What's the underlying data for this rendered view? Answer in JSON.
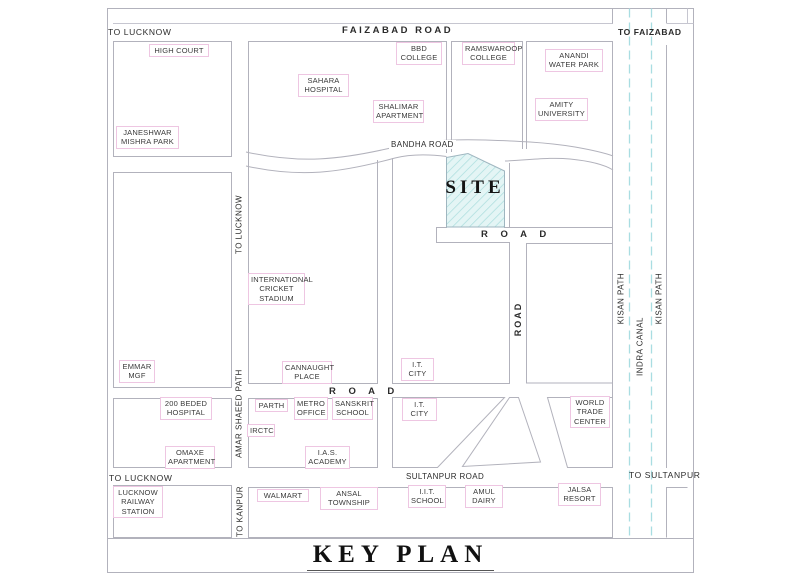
{
  "title": {
    "text": "KEY PLAN"
  },
  "site": {
    "label": "SITE"
  },
  "roads": {
    "to_lucknow_top": "TO LUCKNOW",
    "faizabad_road": "FAIZABAD ROAD",
    "to_faizabad": "TO FAIZABAD",
    "bandha_road": "BANDHA ROAD",
    "road_site": "R O A D",
    "road_mid": "R O A D",
    "road_vertical": "ROAD",
    "sultanpur_road": "SULTANPUR ROAD",
    "to_sultanpur": "TO SULTANPUR",
    "to_lucknow_bottom": "TO LUCKNOW",
    "to_lucknow_left": "TO LUCKNOW",
    "amar_shaeed_path": "AMAR SHAEED PATH",
    "to_kanpur": "TO KANPUR",
    "kisan_path_west": "KISAN PATH",
    "kisan_path_east": "KISAN PATH",
    "indra_canal": "INDRA CANAL"
  },
  "places": {
    "high_court": "HIGH COURT",
    "janeshwar_mishra_park": "JANESHWAR\nMISHRA PARK",
    "sahara_hospital": "SAHARA\nHOSPITAL",
    "bbd_college": "BBD\nCOLLEGE",
    "ramswaroop_college": "RAMSWAROOP\nCOLLEGE",
    "anandi_water_park": "ANANDI\nWATER PARK",
    "shalimar_apartment": "SHALIMAR\nAPARTMENT",
    "amity_university": "AMITY\nUNIVERSITY",
    "international_cricket_stadium": "INTERNATIONAL\nCRICKET\nSTADIUM",
    "emmar_mgf": "EMMAR\nMGF",
    "cannaught_place": "CANNAUGHT\nPLACE",
    "it_city_upper": "I.T.\nCITY",
    "beded_hospital": "200 BEDED\nHOSPITAL",
    "omaxe_apartment": "OMAXE\nAPARTMENT",
    "parth": "PARTH",
    "metro_office": "METRO\nOFFICE",
    "sanskrit_school": "SANSKRIT\nSCHOOL",
    "irctc": "IRCTC",
    "ias_academy": "I.A.S.\nACADEMY",
    "it_city_lower": "I.T.\nCITY",
    "world_trade_center": "WORLD\nTRADE\nCENTER",
    "lucknow_railway_station": "LUCKNOW\nRAILWAY\nSTATION",
    "walmart": "WALMART",
    "ansal_township": "ANSAL\nTOWNSHIP",
    "iit_school": "I.I.T.\nSCHOOL",
    "amul_dairy": "AMUL\nDAIRY",
    "jalsa_resort": "JALSA\nRESORT"
  },
  "colors": {
    "line": "#b2b2bc",
    "light_line": "#c6c6d0",
    "canal": "#a9dde2",
    "label_border": "#eec6e2",
    "site_fill": "#e4f5f5",
    "site_hatch": "#a8dcdc",
    "text": "#3a3a3a"
  }
}
